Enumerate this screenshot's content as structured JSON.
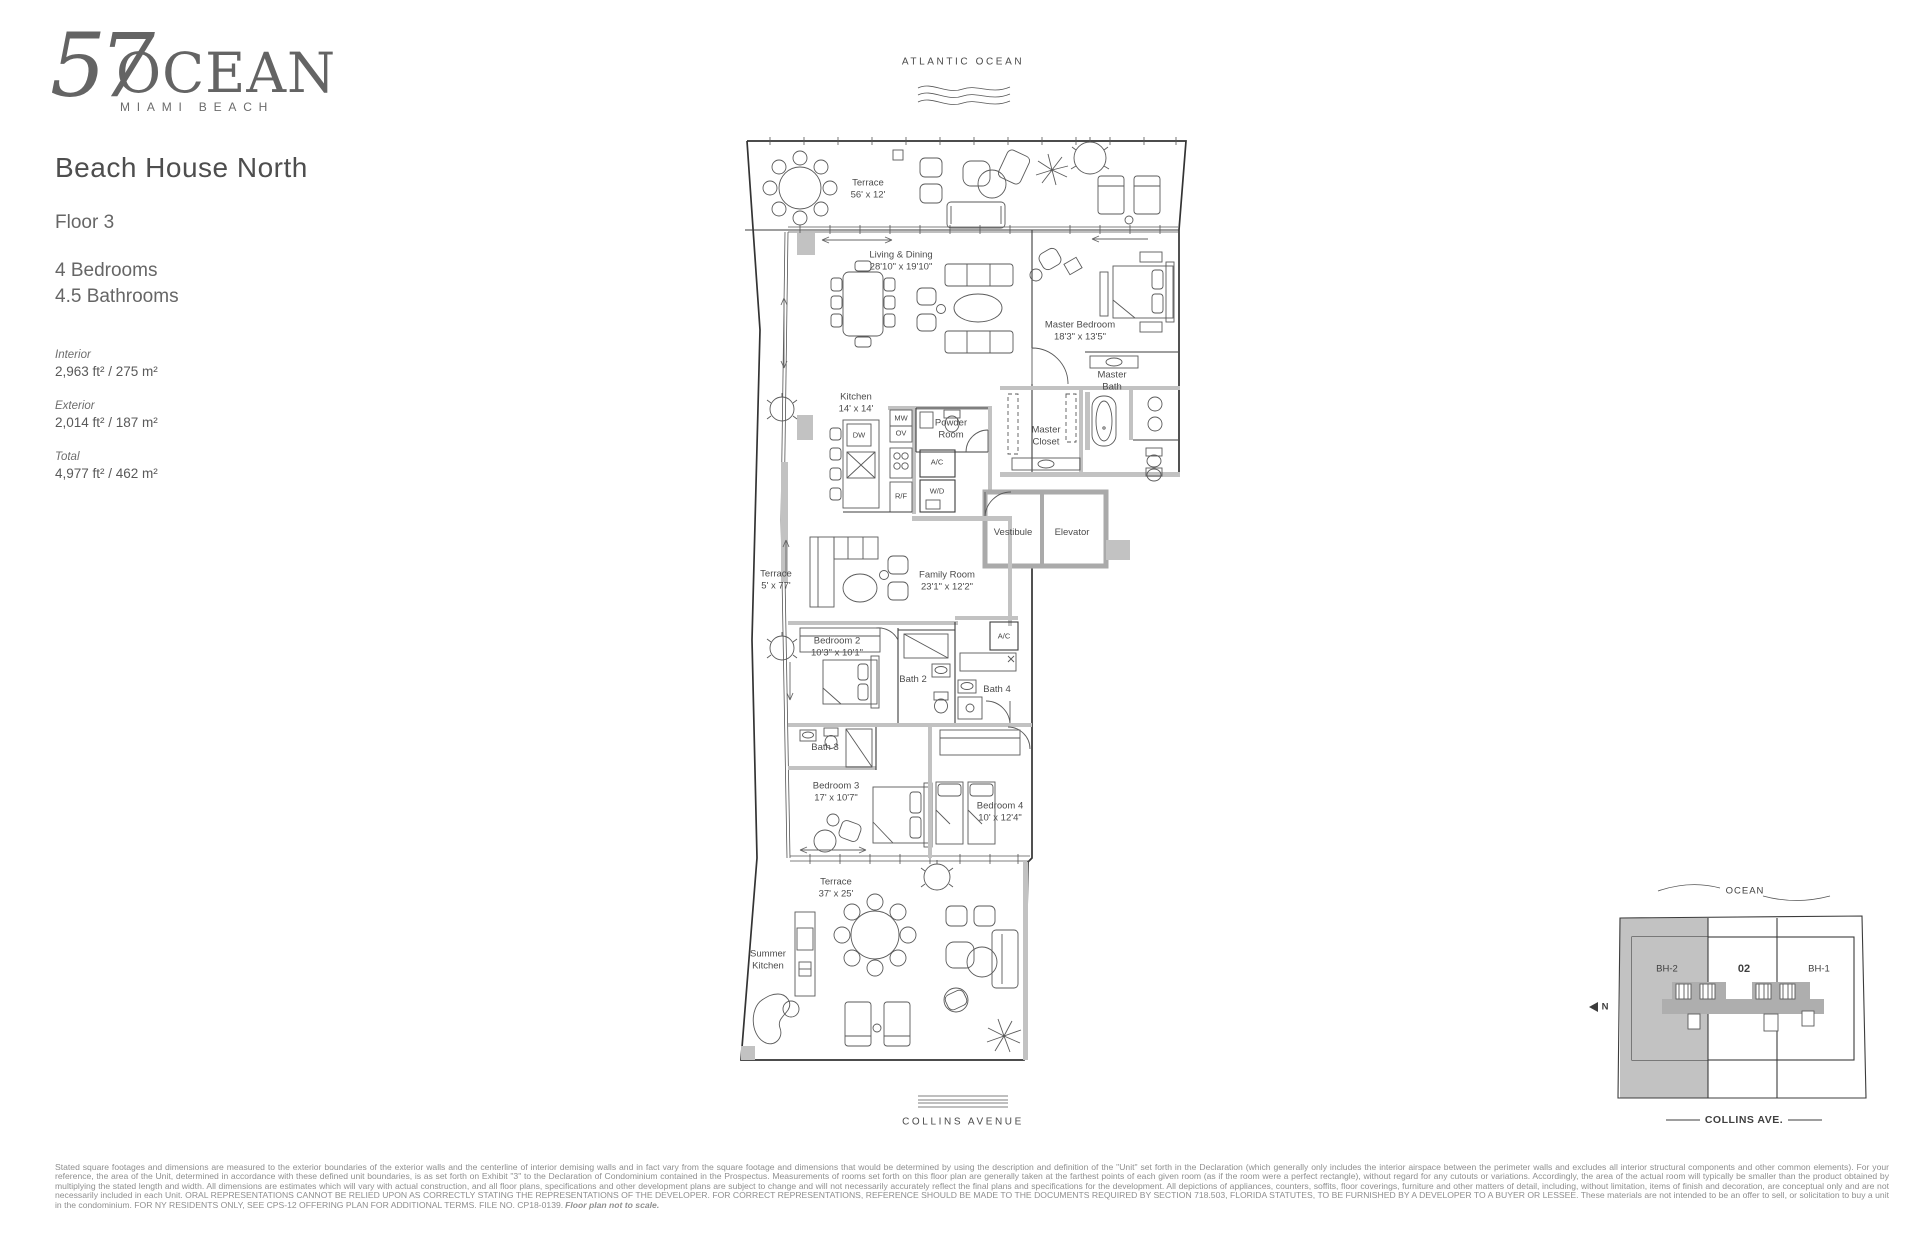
{
  "logo": {
    "number": "57",
    "word": "OCEAN",
    "tagline": "MIAMI BEACH"
  },
  "info": {
    "unit_name": "Beach House North",
    "floor": "Floor 3",
    "bedrooms": "4 Bedrooms",
    "bathrooms": "4.5 Bathrooms",
    "areas": [
      {
        "label": "Interior",
        "value": "2,963 ft² / 275 m²"
      },
      {
        "label": "Exterior",
        "value": "2,014 ft² / 187 m²"
      },
      {
        "label": "Total",
        "value": "4,977 ft² / 462 m²"
      }
    ]
  },
  "plan": {
    "atlantic_label": "ATLANTIC OCEAN",
    "collins_label": "COLLINS AVENUE",
    "rooms": [
      {
        "l1": "Terrace",
        "l2": "56' x 12'"
      },
      {
        "l1": "Living & Dining",
        "l2": "28'10\" x 19'10\""
      },
      {
        "l1": "Master Bedroom",
        "l2": "18'3\" x 13'5\""
      },
      {
        "l1": "Master",
        "l2": "Bath"
      },
      {
        "l1": "Kitchen",
        "l2": "14' x 14'"
      },
      {
        "l1": "Powder",
        "l2": "Room"
      },
      {
        "l1": "Master",
        "l2": "Closet"
      },
      {
        "l1": "Vestibule"
      },
      {
        "l1": "Elevator"
      },
      {
        "l1": "Terrace",
        "l2": "5' x 77'"
      },
      {
        "l1": "Family Room",
        "l2": "23'1\" x 12'2\""
      },
      {
        "l1": "Bedroom 2",
        "l2": "10'3\" x 10'1\""
      },
      {
        "l1": "Bath 2"
      },
      {
        "l1": "Bath 4"
      },
      {
        "l1": "Bath 3"
      },
      {
        "l1": "Bedroom 3",
        "l2": "17' x 10'7\""
      },
      {
        "l1": "Bedroom 4",
        "l2": "10' x 12'4\""
      },
      {
        "l1": "Terrace",
        "l2": "37' x 25'"
      },
      {
        "l1": "Summer",
        "l2": "Kitchen"
      }
    ],
    "appliances": [
      {
        "t": "MW"
      },
      {
        "t": "OV"
      },
      {
        "t": "DW"
      },
      {
        "t": "A/C"
      },
      {
        "t": "R/F"
      },
      {
        "t": "W/D"
      },
      {
        "t": "A/C"
      }
    ]
  },
  "sitemap": {
    "ocean": "OCEAN",
    "unit_left": "BH-2",
    "unit_mid": "02",
    "unit_right": "BH-1",
    "north": "N",
    "street": "COLLINS AVE."
  },
  "disclaimer": {
    "text": "Stated square footages and dimensions are measured to the exterior boundaries of the exterior walls and the centerline of interior demising walls and in fact vary from the square footage and dimensions that would be determined by using the description and definition of the \"Unit\" set forth in the Declaration (which generally only includes the interior airspace between the perimeter walls and excludes all interior structural components and other common elements). For your reference, the area of the Unit, determined in accordance with these defined unit boundaries, is as set forth on Exhibit \"3\" to the Declaration of Condominium contained in the Prospectus. Measurements of rooms set forth on this floor plan are generally taken at the farthest points of each given room (as if the room were a perfect rectangle), without regard for any cutouts or variations. Accordingly, the area of the actual room will typically be smaller than the product obtained by multiplying the stated length and width. All dimensions are estimates which will vary with actual construction, and all floor plans, specifications and other development plans are subject to change and will not necessarily accurately reflect the final plans and specifications for the development. All depictions of appliances, counters, soffits, floor coverings, furniture and other matters of detail, including, without limitation, items of finish and decoration, are conceptual only and are not necessarily included in each Unit. ORAL REPRESENTATIONS CANNOT BE RELIED UPON AS CORRECTLY STATING THE REPRESENTATIONS OF THE DEVELOPER. FOR CORRECT REPRESENTATIONS, REFERENCE SHOULD BE MADE TO THE DOCUMENTS REQUIRED BY SECTION 718.503, FLORIDA STATUTES, TO BE FURNISHED BY A DEVELOPER TO A BUYER OR LESSEE. These materials are not intended to be an offer to sell, or solicitation to buy a unit in the condominium. FOR NY RESIDENTS ONLY, SEE CPS-12 OFFERING PLAN FOR ADDITIONAL TERMS. FILE NO. CP18-0139.",
    "note": "Floor plan not to scale."
  }
}
